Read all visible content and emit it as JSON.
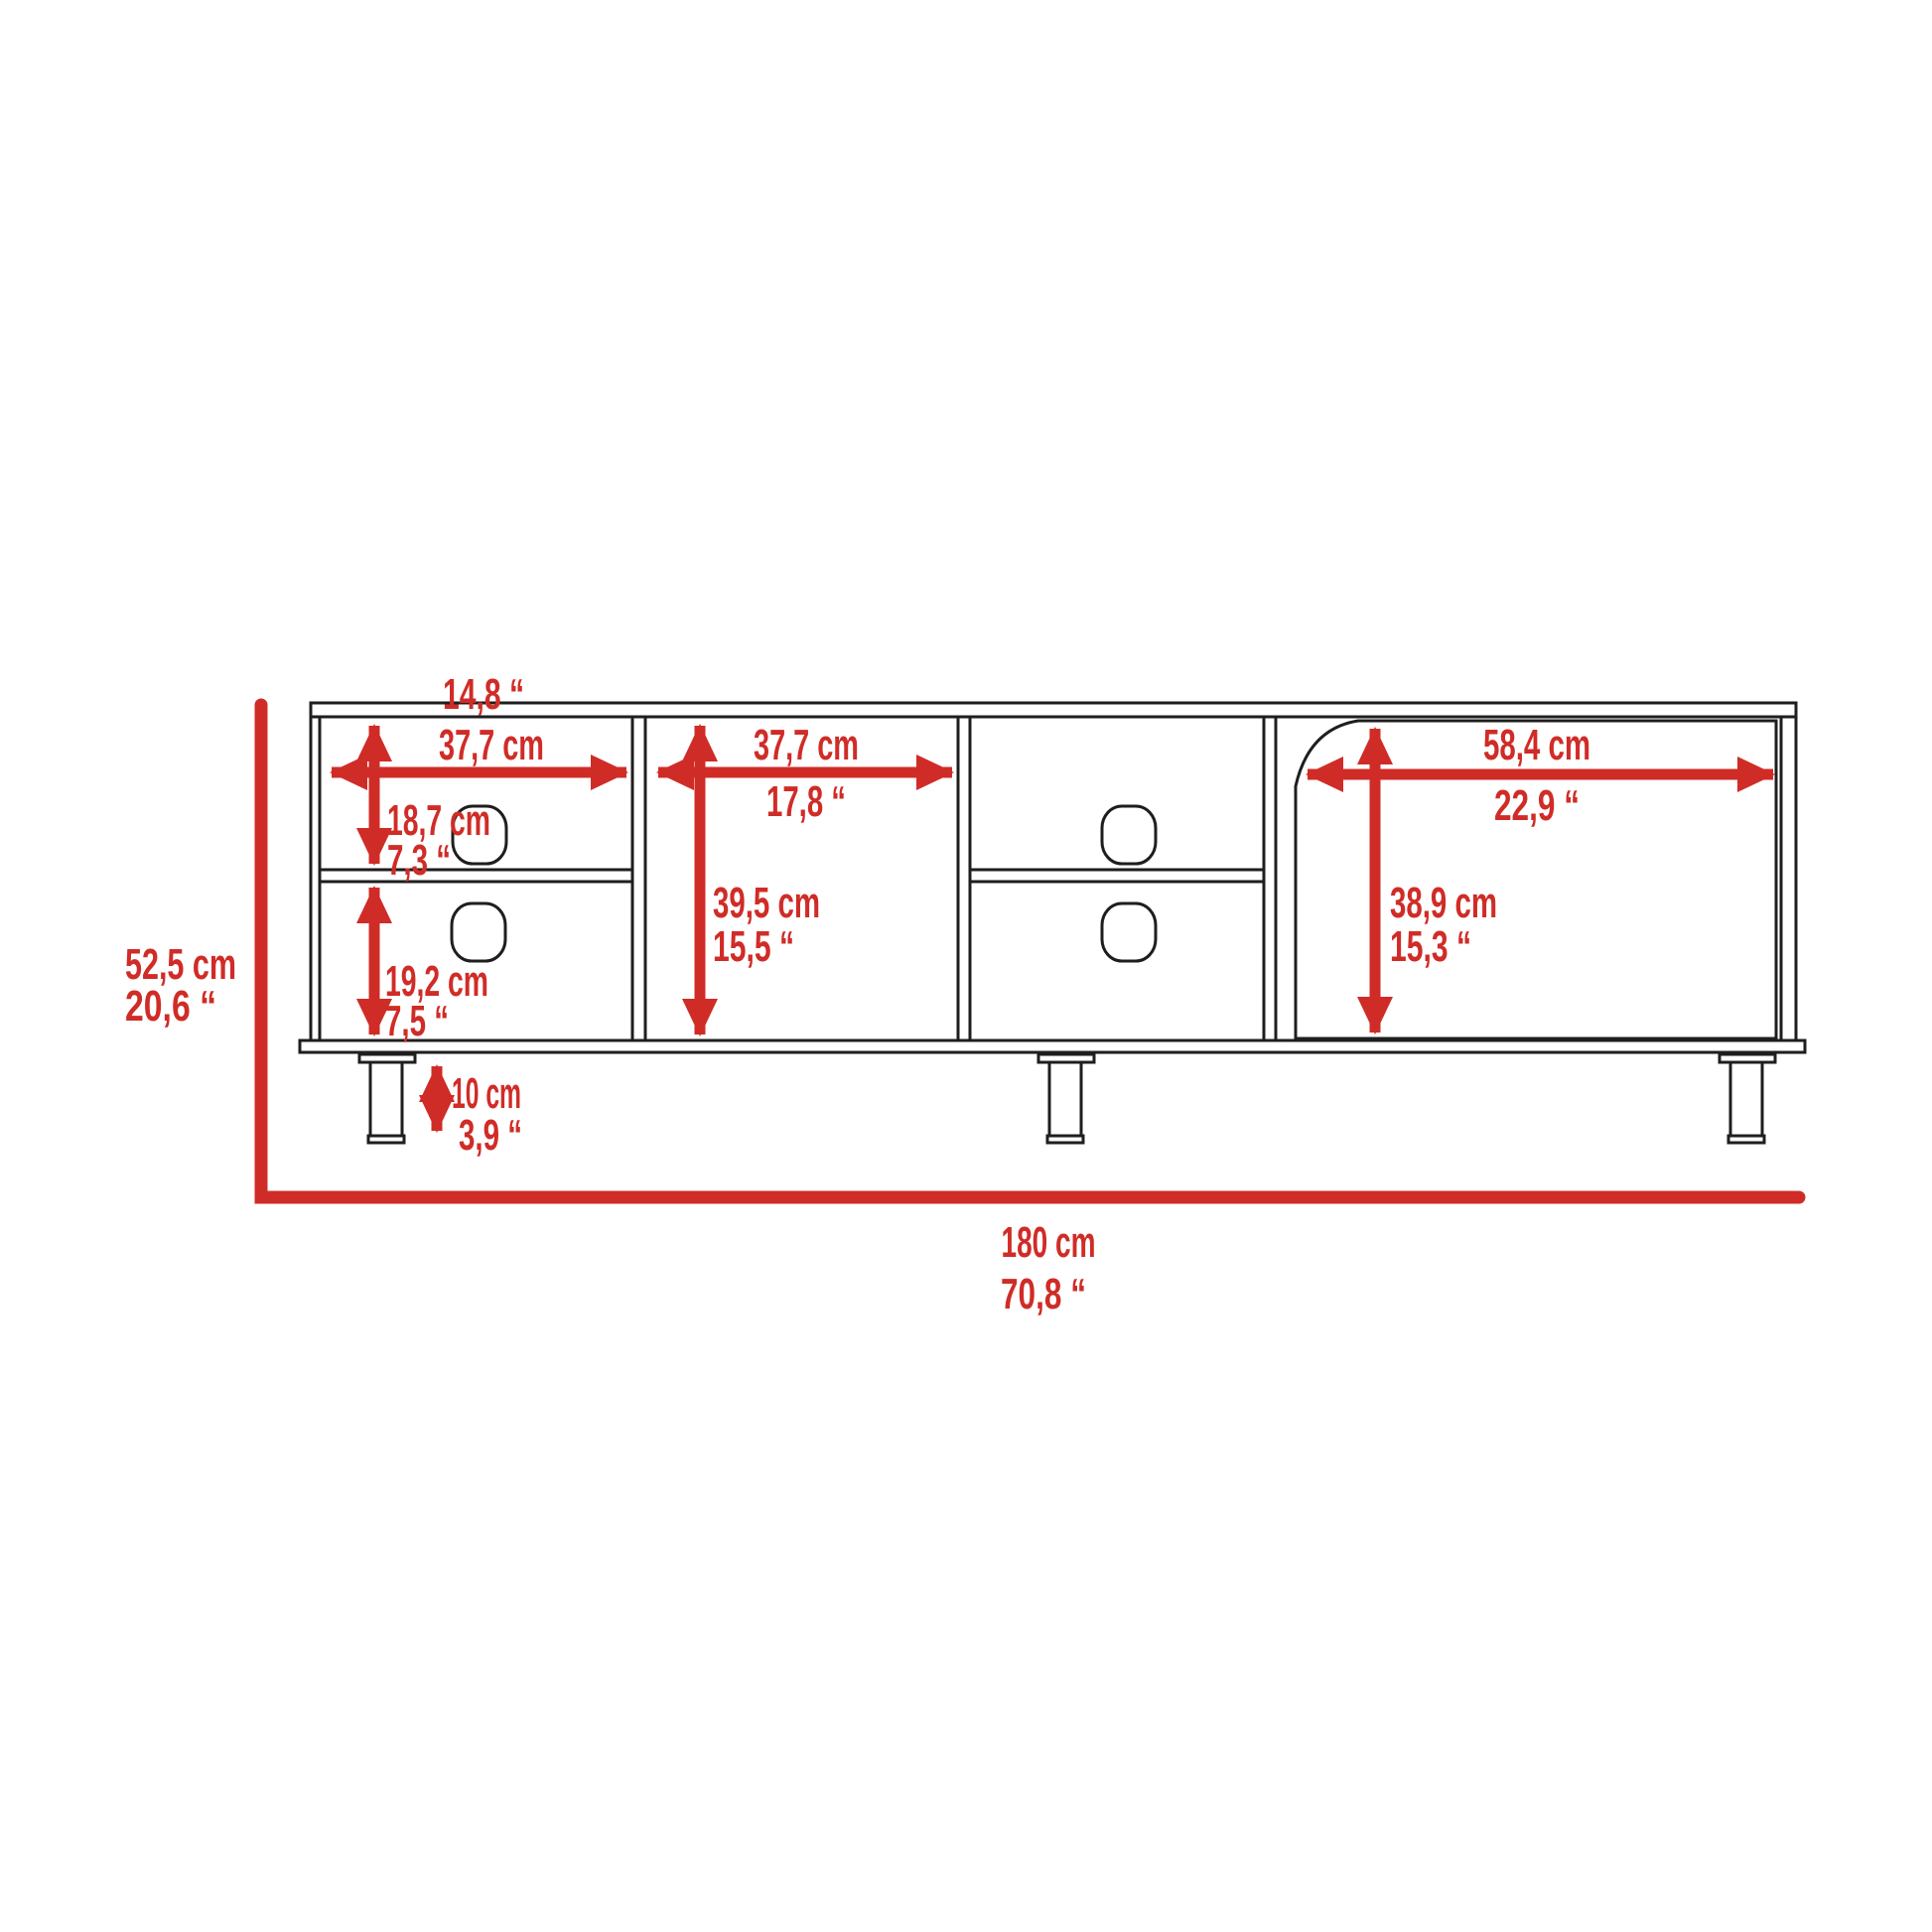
{
  "diagram": {
    "type": "furniture-dimension-drawing",
    "subject": "TV stand front elevation with dimension arrows",
    "accent_color": "#d02c27",
    "line_color": "#1e1e1e",
    "background_color": "#ffffff",
    "labels": {
      "section1_width_in": "14,8 “",
      "section1_width_cm": "37,7 cm",
      "section2_width_cm": "37,7 cm",
      "section2_width_in": "17,8 “",
      "door_width_cm": "58,4 cm",
      "door_width_in": "22,9 “",
      "upper_shelf_height_cm": "18,7 cm",
      "upper_shelf_height_in": "7,3 “",
      "lower_shelf_height_cm": "19,2 cm",
      "lower_shelf_height_in": "7,5 “",
      "inner_height_cm": "39,5 cm",
      "inner_height_in": "15,5 “",
      "door_height_cm": "38,9 cm",
      "door_height_in": "15,3 “",
      "leg_height_cm": "10 cm",
      "leg_height_in": "3,9 “",
      "overall_height_cm": "52,5 cm",
      "overall_height_in": "20,6 “",
      "overall_width_cm": "180 cm",
      "overall_width_in": "70,8 “"
    }
  }
}
